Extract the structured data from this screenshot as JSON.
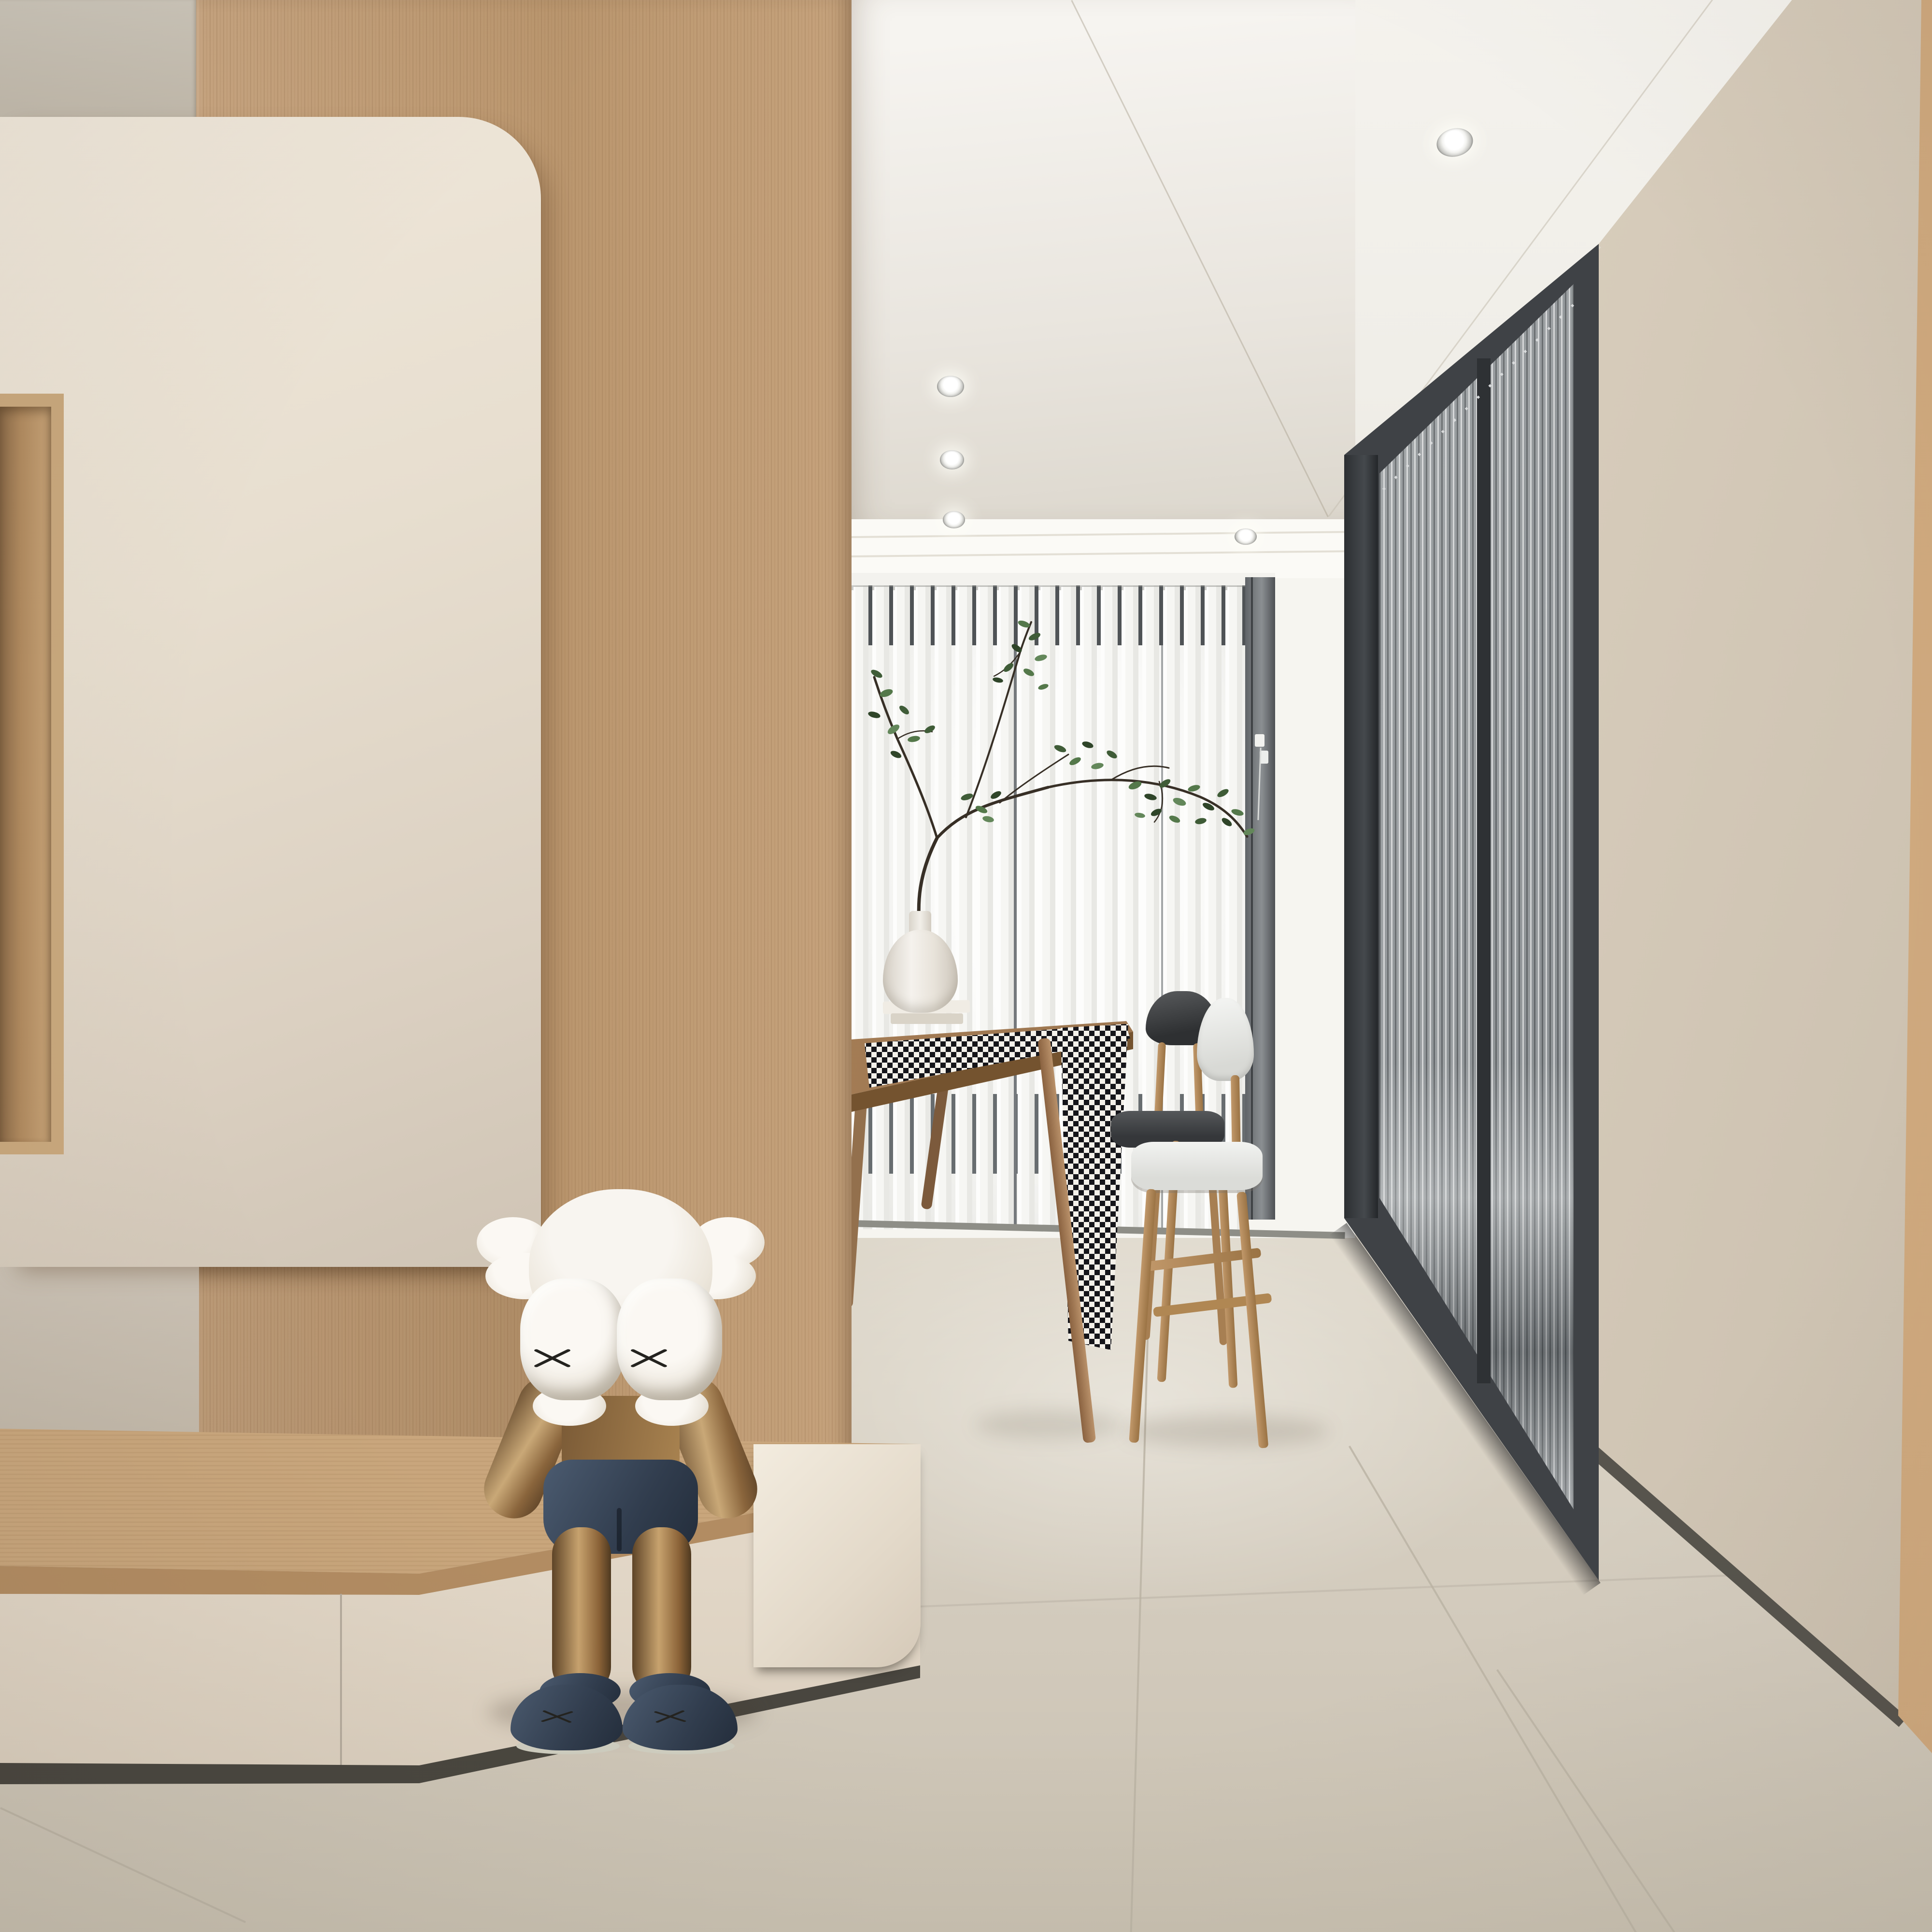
{
  "meta": {
    "domain_hint": "photorealistic 3D interior render, no text or UI elements visible",
    "render_size": "4000x4000"
  },
  "labels": {
    "scene": "Minimalist cream-and-oak interior with KAWS-style sculpture",
    "kaws": "KAWS-style companion figure sitting with hands over face",
    "dining": "Dining nook with vertical blinds, branch arrangement and two chairs",
    "doors": "Black-framed fluted glass sliding doors",
    "tv_wall": "Cream TV wall panel with rounded corner over oak feature wall",
    "bench": "Floating oak bench cabinet with cream drawer fronts",
    "floor": "Large-format beige porcelain floor tiles"
  },
  "objects": [
    {
      "name": "kaws-figure",
      "pose": "seated, elbows on knees, fists covering face",
      "head_color": "#f3efe8",
      "body_color": "#a9834f",
      "shorts_shoes_color": "#33404f",
      "sole_color": "#cfcec0",
      "marks": "black X on each fist and shoe"
    },
    {
      "name": "tv-panel",
      "color": "#e7decf",
      "corner": "large rounded top-right"
    },
    {
      "name": "wood-feature-wall",
      "color": "#c09a73",
      "grain": "fine vertical"
    },
    {
      "name": "display-niche",
      "lining": "#b08a5f"
    },
    {
      "name": "bench-cabinet",
      "top": "#cdab81",
      "drawers": "#ece3d4",
      "toe_kick": "#49463f",
      "drawer_count_visible": 2
    },
    {
      "name": "column-plinth",
      "color": "#e9dfd0",
      "corner": "rounded bottom-right"
    },
    {
      "name": "vertical-blinds",
      "vane_color": "#fbfbf9",
      "dark_slots": [
        "#4f5356",
        "#686d70"
      ],
      "track": "#f3f2ee"
    },
    {
      "name": "window-jamb",
      "color": "#6f7376",
      "handle": "#f2f2ef"
    },
    {
      "name": "branch-arrangement",
      "stems": "#372f26",
      "leaves": [
        "#3f5c37",
        "#54784a",
        "#2f4529",
        "#63875a"
      ]
    },
    {
      "name": "vase",
      "color": "#ece8e0",
      "shape": "faceted baluster"
    },
    {
      "name": "books-stack",
      "colors": [
        "#f0ece4",
        "#d9d3c7"
      ]
    },
    {
      "name": "dining-table",
      "wood": "#a07a52",
      "legs": "angled round tapered"
    },
    {
      "name": "table-runner",
      "pattern": "black and white houndstooth",
      "colors": [
        "#15151a",
        "#f4f1ea"
      ]
    },
    {
      "name": "chair-black",
      "backrest": "#3a3c3e",
      "seat": "#404244",
      "legs": "#a77f52"
    },
    {
      "name": "chair-white",
      "backrest": "#eef0ee",
      "seat": "#e8e9e6",
      "legs": "#b99061"
    },
    {
      "name": "glass-door-unit",
      "frame": "#3f4246",
      "glass": "fluted, vertical reeds",
      "panels": 2
    },
    {
      "name": "right-wall",
      "color": "#ddd3c3",
      "baseboard": "#57544d"
    },
    {
      "name": "edge-wood-panel",
      "color": "#c49c70"
    },
    {
      "name": "ceiling",
      "color": "#f2f0ea",
      "downlight_count": 5
    },
    {
      "name": "floor-tiles",
      "color": "#d5cec0",
      "grout": "#c0b8a9",
      "format": "large square"
    }
  ],
  "palette": {
    "cream_panel": "#e7decf",
    "oak_wood": "#c09a73",
    "ceiling_white": "#f2f0ea",
    "floor_beige": "#d5cec0",
    "frame_charcoal": "#3f4246",
    "navy": "#33404f",
    "bronze": "#a9834f",
    "leaf_green": "#54784a"
  }
}
